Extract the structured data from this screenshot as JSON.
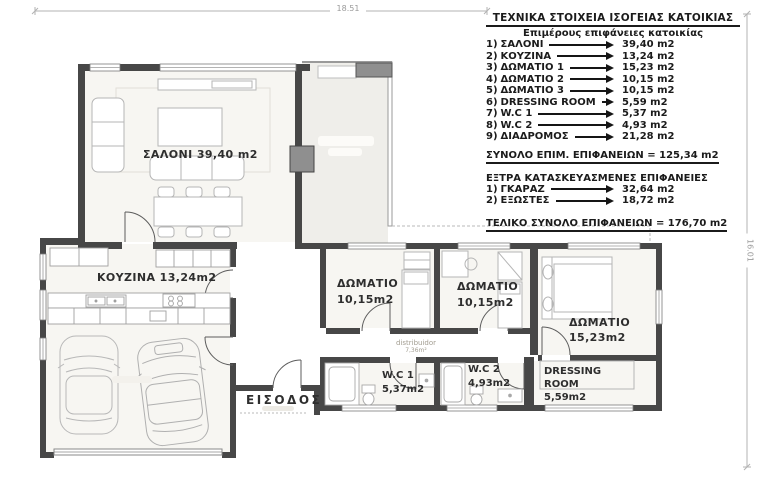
{
  "dimensions": {
    "top": "18.51",
    "right": "16.01"
  },
  "legend": {
    "title": "ΤΕΧΝΙΚΑ  ΣΤΟΙΧΕΙΑ ΙΣΟΓΕΙΑΣ ΚΑΤΟΙΚΙΑΣ",
    "subtitle": "Επιμέρους  επιφάνειες  κατοικίας",
    "items": [
      {
        "num": "1)",
        "label": "ΣΑΛΟΝΙ",
        "value": "39,40 m2"
      },
      {
        "num": "2)",
        "label": "ΚΟΥΖΙΝΑ",
        "value": "13,24 m2"
      },
      {
        "num": "3)",
        "label": "ΔΩΜΑΤΙΟ  1",
        "value": "15,23 m2"
      },
      {
        "num": "4)",
        "label": "ΔΩΜΑΤΙΟ  2",
        "value": "10,15 m2"
      },
      {
        "num": "5)",
        "label": "ΔΩΜΑΤΙΟ  3",
        "value": "10,15 m2"
      },
      {
        "num": "6)",
        "label": "DRESSING ROOM",
        "value": "5,59 m2"
      },
      {
        "num": "7)",
        "label": "W.C  1",
        "value": "5,37 m2"
      },
      {
        "num": "8)",
        "label": "W.C  2",
        "value": "4,93 m2"
      },
      {
        "num": "9)",
        "label": "ΔΙΑΔΡΟΜΟΣ",
        "value": "21,28 m2"
      }
    ],
    "subtotal": "ΣΥΝΟΛΟ ΕΠΙΜ. ΕΠΙΦΑΝΕΙΩΝ = 125,34 m2",
    "extra_title": "ΕΞΤΡΑ ΚΑΤΑΣΚΕΥΑΣΜΕΝΕΣ ΕΠΙΦΑΝΕΙΕΣ",
    "extra_items": [
      {
        "num": "1)",
        "label": "ΓΚΑΡΑΖ",
        "value": "32,64 m2"
      },
      {
        "num": "2)",
        "label": "ΕΞΩΣΤΕΣ",
        "value": "18,72 m2"
      }
    ],
    "grand_total": "ΤΕΛΙΚΟ ΣΥΝΟΛΟ  ΕΠΙΦΑΝΕΙΩΝ  = 176,70 m2"
  },
  "rooms": {
    "living": {
      "label": "ΣΑΛΟΝΙ 39,40 m2"
    },
    "kitchen": {
      "label": "ΚΟΥΖΙΝΑ 13,24m2"
    },
    "bedroom2": {
      "line1": "ΔΩΜΑΤΙΟ",
      "line2": "10,15m2"
    },
    "bedroom3": {
      "line1": "ΔΩΜΑΤΙΟ",
      "line2": "10,15m2"
    },
    "bedroom1": {
      "line1": "ΔΩΜΑΤΙΟ",
      "line2": "15,23m2"
    },
    "wc1": {
      "line1": "W.C  1",
      "line2": "5,37m2"
    },
    "wc2": {
      "line1": "W.C  2",
      "line2": "4,93m2"
    },
    "dressing": {
      "line1": "DRESSING",
      "line2": "ROOM",
      "line3": "5,59m2"
    },
    "entrance": {
      "label": "ΕΙΣΟΔΟΣ"
    },
    "corridor": {
      "line1": "distribuidor",
      "line2": "7,36m²"
    }
  },
  "colors": {
    "wall": "#474747",
    "room_fill": "#f7f6f2",
    "terrace_fill": "#efeeea",
    "label_text": "#2e2e2e",
    "legend_text": "#1b1b1b",
    "dimension": "#9b9b9b",
    "furniture_stroke": "#b5b5b5"
  }
}
